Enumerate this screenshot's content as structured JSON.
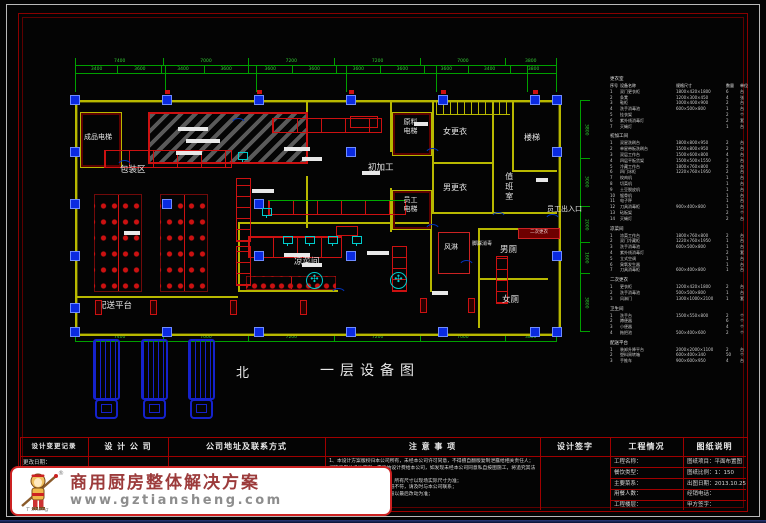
{
  "sheet": {
    "bg_color": "#000000",
    "frame_color": "#b9b9b9",
    "border_color": "#8a0000",
    "wall_color": "#b8b800",
    "equipment_color": "#cc1111",
    "column_color": "#0a2ae0",
    "dimension_color": "#33cc33",
    "accent_cyan": "#00cccc"
  },
  "plan": {
    "north_label": "北",
    "drawing_title": "一层设备图",
    "labels": [
      {
        "id": "finished-goods-elevator",
        "text": "成品电梯"
      },
      {
        "id": "packing-area",
        "text": "包装区"
      },
      {
        "id": "initial-processing",
        "text": "初加工"
      },
      {
        "id": "raw-material-elevator",
        "text": "原料电梯"
      },
      {
        "id": "women-changing-room",
        "text": "女更衣"
      },
      {
        "id": "men-changing-room",
        "text": "男更衣"
      },
      {
        "id": "staircase",
        "text": "楼梯"
      },
      {
        "id": "duty-room",
        "text": "值班室"
      },
      {
        "id": "staff-elevator",
        "text": "员工电梯"
      },
      {
        "id": "staff-entrance",
        "text": "员工出入口"
      },
      {
        "id": "air-shower",
        "text": "风淋"
      },
      {
        "id": "foot-sanitizer",
        "text": "脚踩消毒"
      },
      {
        "id": "men-toilet",
        "text": "男厕"
      },
      {
        "id": "women-toilet",
        "text": "女厕"
      },
      {
        "id": "cold-dish-room",
        "text": "凉菜间"
      },
      {
        "id": "delivery-platform",
        "text": "配送平台"
      },
      {
        "id": "second-changing",
        "text": "二次更衣"
      }
    ]
  },
  "dims": {
    "top_row1": [
      "7400",
      "7000",
      "7200",
      "7200",
      "7000",
      "3800"
    ],
    "top_row2": [
      "3400",
      "3600",
      "3400",
      "3600",
      "3600",
      "3600",
      "3600",
      "3600",
      "3600",
      "3400",
      "3800"
    ],
    "bottom": [
      "7400",
      "7000",
      "7200",
      "7200",
      "7000",
      "3800"
    ],
    "right": [
      "3800",
      "3000",
      "2000",
      "1600",
      "3800"
    ]
  },
  "equipment_table": {
    "columns": [
      "序号",
      "设备名称",
      "规格尺寸",
      "数量",
      "单位"
    ],
    "sections": [
      {
        "name": "更衣室",
        "rows": [
          [
            "1",
            "双门更衣柜",
            "1800×420×1800",
            "6",
            "台"
          ],
          [
            "2",
            "条凳",
            "1200×300×450",
            "4",
            "张"
          ],
          [
            "3",
            "鞋柜",
            "1000×400×900",
            "2",
            "台"
          ],
          [
            "4",
            "洗手消毒池",
            "600×500×800",
            "1",
            "台"
          ],
          [
            "5",
            "挂衣架",
            "",
            "2",
            "个"
          ],
          [
            "6",
            "紫外线消毒灯",
            "",
            "2",
            "套"
          ],
          [
            "7",
            "灭蝇灯",
            "",
            "1",
            "台"
          ]
        ]
      },
      {
        "name": "初加工间",
        "rows": [
          [
            "1",
            "双星洗刷台",
            "1800×800×950",
            "2",
            "台"
          ],
          [
            "2",
            "单星带板洗刷台",
            "1500×800×950",
            "2",
            "台"
          ],
          [
            "3",
            "双层工作台",
            "1500×600×800",
            "4",
            "台"
          ],
          [
            "4",
            "四层平板货架",
            "1500×500×1550",
            "3",
            "台"
          ],
          [
            "5",
            "冷藏工作台",
            "1800×760×800",
            "2",
            "台"
          ],
          [
            "6",
            "四门冰柜",
            "1220×760×1950",
            "2",
            "台"
          ],
          [
            "7",
            "绞肉机",
            "",
            "1",
            "台"
          ],
          [
            "8",
            "切菜机",
            "",
            "1",
            "台"
          ],
          [
            "9",
            "土豆脱皮机",
            "",
            "1",
            "台"
          ],
          [
            "10",
            "锯骨机",
            "",
            "1",
            "台"
          ],
          [
            "11",
            "电子秤",
            "",
            "1",
            "台"
          ],
          [
            "12",
            "刀具消毒柜",
            "900×400×800",
            "1",
            "台"
          ],
          [
            "13",
            "砧板架",
            "",
            "2",
            "个"
          ],
          [
            "14",
            "灭蝇灯",
            "",
            "2",
            "台"
          ]
        ]
      },
      {
        "name": "凉菜间",
        "rows": [
          [
            "1",
            "凉菜工作台",
            "1800×760×800",
            "2",
            "台"
          ],
          [
            "2",
            "双门冷藏柜",
            "1220×760×1950",
            "1",
            "台"
          ],
          [
            "3",
            "洗手消毒池",
            "600×500×800",
            "1",
            "台"
          ],
          [
            "4",
            "紫外线消毒灯",
            "",
            "2",
            "套"
          ],
          [
            "5",
            "立式空调",
            "",
            "1",
            "台"
          ],
          [
            "6",
            "臭氧发生器",
            "",
            "1",
            "台"
          ],
          [
            "7",
            "刀具消毒柜",
            "600×400×800",
            "1",
            "台"
          ]
        ]
      },
      {
        "name": "二次更衣",
        "rows": [
          [
            "1",
            "更衣柜",
            "1200×420×1800",
            "2",
            "台"
          ],
          [
            "2",
            "洗手消毒池",
            "500×500×800",
            "1",
            "台"
          ],
          [
            "3",
            "风淋门",
            "1300×1000×2100",
            "1",
            "套"
          ]
        ]
      },
      {
        "name": "卫生间",
        "rows": [
          [
            "1",
            "洗手台",
            "1500×550×800",
            "2",
            "个"
          ],
          [
            "2",
            "蹲便器",
            "",
            "6",
            "个"
          ],
          [
            "3",
            "小便器",
            "",
            "4",
            "个"
          ],
          [
            "4",
            "拖把池",
            "500×400×600",
            "2",
            "个"
          ]
        ]
      },
      {
        "name": "配送平台",
        "rows": [
          [
            "1",
            "装卸升降平台",
            "2000×2000×1100",
            "2",
            "台"
          ],
          [
            "2",
            "塑料周转箱",
            "600×400×340",
            "50",
            "个"
          ],
          [
            "3",
            "手推车",
            "900×600×950",
            "4",
            "台"
          ]
        ]
      }
    ]
  },
  "title_block": {
    "change_record": {
      "title": "设计变更记录",
      "rows": [
        "更改日期："
      ]
    },
    "design_company": {
      "title": "设 计 公 司"
    },
    "address": {
      "title": "公司地址及联系方式"
    },
    "notes": {
      "title": "注 意 事 项",
      "items": [
        "1、本设计方案版权归本公司所有，未经本公司许可同意，不得擅自翻版复制泄露给相关责任人；如欲采用此设计方案，需缴纳设计费给本公司，如发现未经本公司同意私自按图施工，将追究其法律责任。",
        "2、此图纸为概念性设计图纸，所有尺寸以现场实际尺寸为准；",
        "3、数量与尺寸如有误差与图纸不符，请及时与本公司联系；",
        "4、本设计方案如有改动，一般以最后改动为准；"
      ]
    },
    "signature": {
      "title": "设计签字"
    },
    "project": {
      "title": "工程情况",
      "rows": [
        "工程名称：",
        "餐饮类型：",
        "主要菜系：",
        "用餐人数：",
        "工程楼层："
      ]
    },
    "drawing_info": {
      "title": "图纸说明",
      "rows": [
        "图纸项目：平面布置图",
        "图纸比例：1：150",
        "出图日期：2013.10.25",
        "经销电话：",
        "甲方签字："
      ]
    }
  },
  "watermark": {
    "slogan": "商用厨房整体解决方案",
    "url": "www.gztiansheng.com",
    "registered": "®",
    "logo_caption": "T Sheng"
  }
}
